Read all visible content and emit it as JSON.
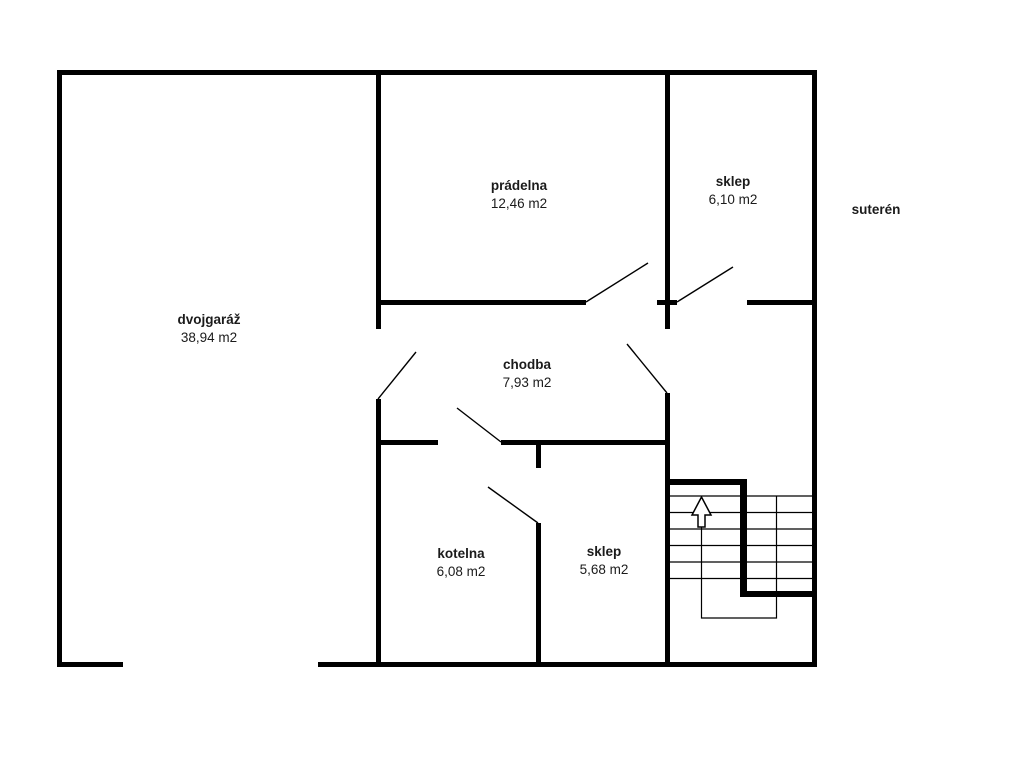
{
  "floor_label": "suterén",
  "rooms": [
    {
      "name": "dvojgaráž",
      "area": "38,94 m2"
    },
    {
      "name": "prádelna",
      "area": "12,46 m2"
    },
    {
      "name": "sklep",
      "area": "6,10 m2"
    },
    {
      "name": "chodba",
      "area": "7,93 m2"
    },
    {
      "name": "kotelna",
      "area": "6,08 m2"
    },
    {
      "name": "sklep",
      "area": "5,68 m2"
    }
  ],
  "colors": {
    "wall": "#000000",
    "background": "#ffffff",
    "text": "#1b1b1b"
  },
  "plan": {
    "walls": [
      [
        57,
        70,
        760,
        5
      ],
      [
        57,
        70,
        5,
        597
      ],
      [
        812,
        70,
        5,
        597
      ],
      [
        57,
        662,
        66,
        5
      ],
      [
        318,
        662,
        499,
        5
      ],
      [
        376,
        70,
        5,
        259
      ],
      [
        376,
        399,
        5,
        268
      ],
      [
        665,
        70,
        5,
        259
      ],
      [
        665,
        393,
        5,
        274
      ],
      [
        378,
        300,
        208,
        5
      ],
      [
        657,
        300,
        20,
        5
      ],
      [
        747,
        300,
        65,
        5
      ],
      [
        378,
        440,
        60,
        5
      ],
      [
        501,
        440,
        169,
        5
      ],
      [
        536,
        440,
        5,
        28
      ],
      [
        536,
        523,
        5,
        144
      ],
      [
        670,
        479,
        74,
        6
      ],
      [
        740,
        479,
        7,
        118
      ],
      [
        740,
        591,
        72,
        6
      ]
    ],
    "doors": [
      [
        378,
        399,
        416,
        352
      ],
      [
        586,
        302,
        648,
        263
      ],
      [
        677,
        302,
        733,
        267
      ],
      [
        667,
        393,
        627,
        344
      ],
      [
        501,
        442,
        457,
        408
      ],
      [
        538,
        523,
        488,
        487
      ]
    ],
    "stairs": {
      "treads": [
        [
          670,
          496,
          812,
          496
        ],
        [
          670,
          512.5,
          812,
          512.5
        ],
        [
          670,
          529,
          812,
          529
        ],
        [
          670,
          545.5,
          812,
          545.5
        ],
        [
          670,
          562,
          812,
          562
        ],
        [
          670,
          578.5,
          812,
          578.5
        ]
      ],
      "walk_line": "701.5,526 701.5,618 776.5,618 776.5,496",
      "arrow": "701.5,497 711,515 705,515 705,527 698,527 698,515 692,515"
    }
  }
}
